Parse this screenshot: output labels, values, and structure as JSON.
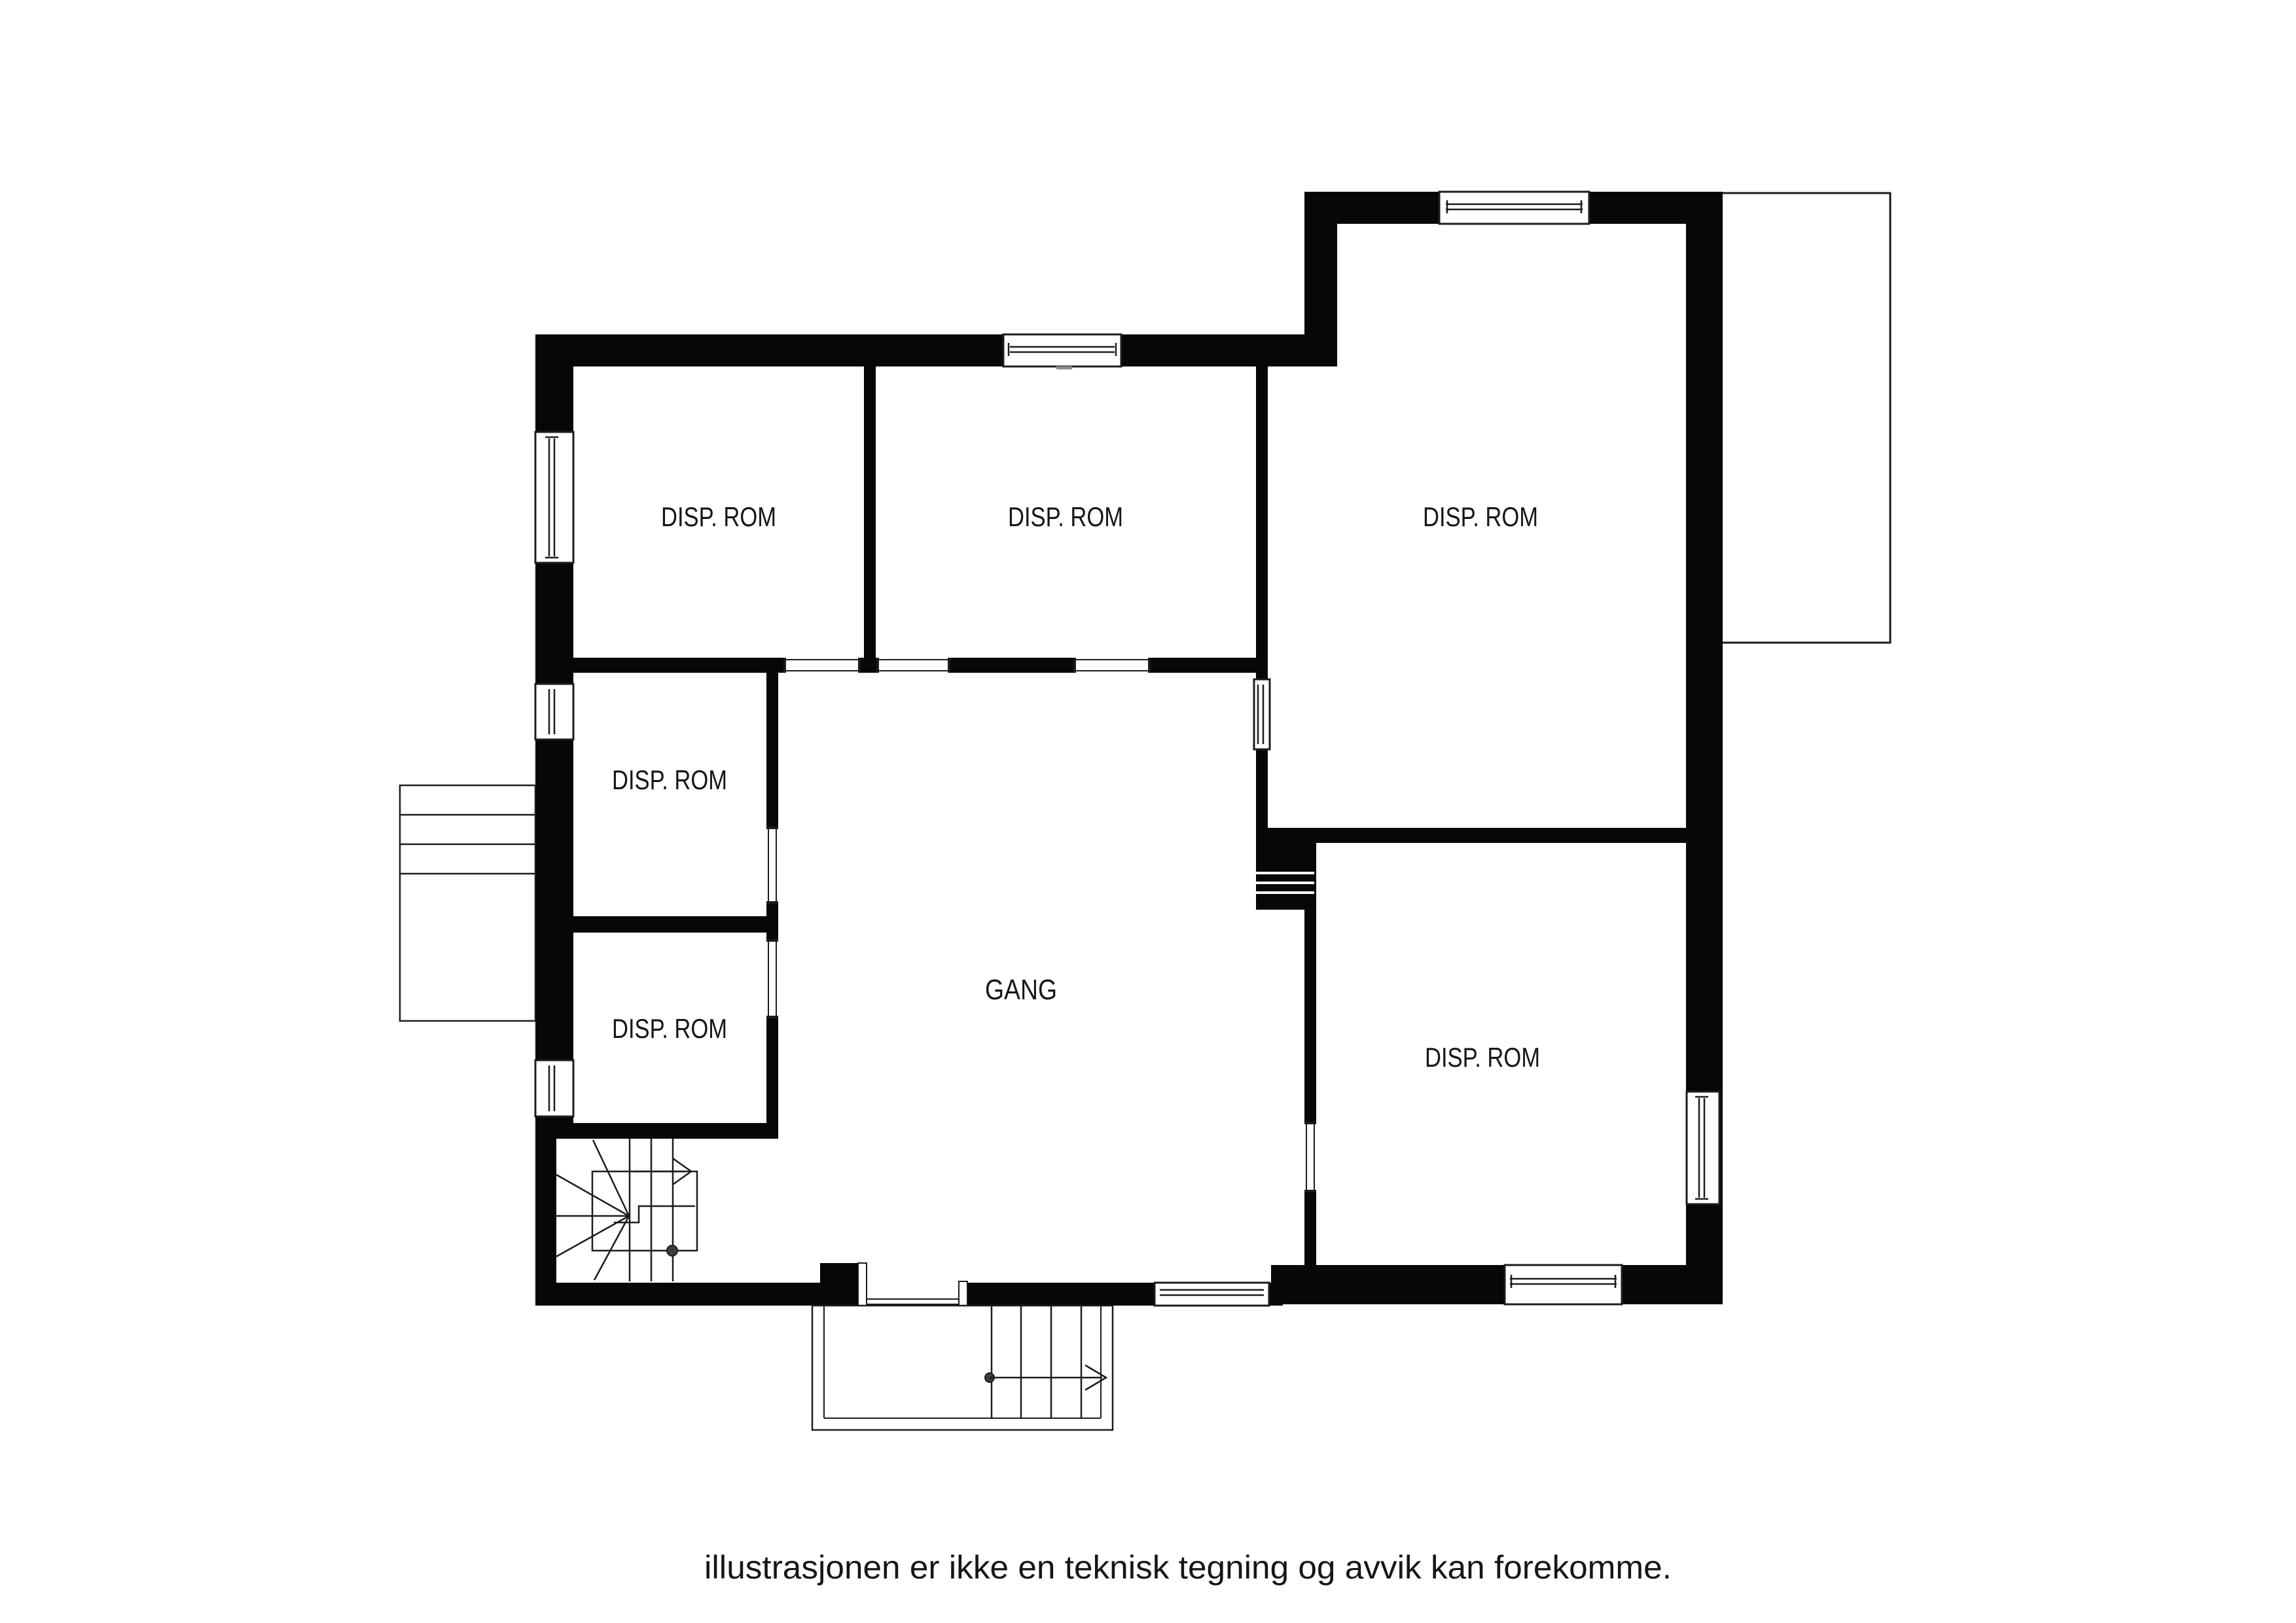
{
  "plan": {
    "caption": "illustrasjonen er ikke en teknisk tegning og avvik kan forekomme.",
    "colors": {
      "wall": "#070707",
      "line": "#1c1c1c",
      "text": "#161616",
      "background": "#ffffff",
      "stair_dot": "#3d3d3d"
    },
    "rooms": [
      {
        "id": "disp-rom-top-left",
        "label": "DISP. ROM"
      },
      {
        "id": "disp-rom-top-middle",
        "label": "DISP. ROM"
      },
      {
        "id": "disp-rom-top-right",
        "label": "DISP. ROM"
      },
      {
        "id": "disp-rom-left-middle",
        "label": "DISP. ROM"
      },
      {
        "id": "disp-rom-left-lower",
        "label": "DISP. ROM"
      },
      {
        "id": "gang",
        "label": "GANG"
      },
      {
        "id": "disp-rom-bottom-right",
        "label": "DISP. ROM"
      }
    ]
  }
}
